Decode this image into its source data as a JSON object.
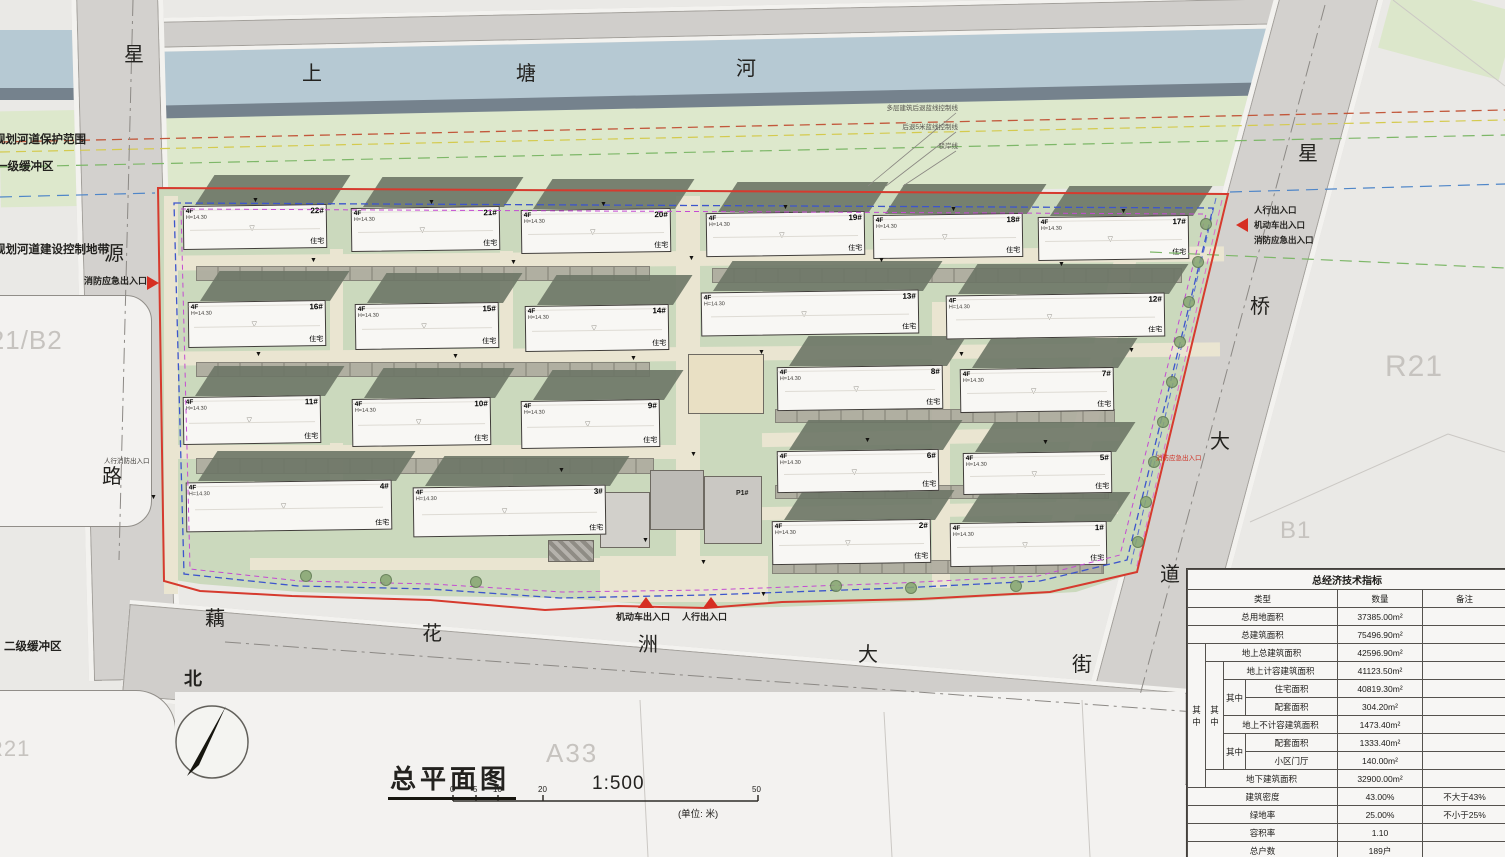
{
  "map": {
    "roads": {
      "north_river_name": [
        "上",
        "塘",
        "河"
      ],
      "west_road_name": [
        "星",
        "源",
        "路"
      ],
      "east_road_name": [
        "星",
        "桥",
        "大",
        "道"
      ],
      "south_road_name": [
        "藕",
        "花",
        "洲",
        "大",
        "街"
      ]
    },
    "zone_labels": {
      "west": "R21/B2",
      "northeast": "R21",
      "east": "B1",
      "south": "A33",
      "southwest": "R21"
    },
    "buffer_labels": {
      "river_protection": "规划河道保护范围",
      "first_buffer": "一级缓冲区",
      "river_control": "规划河道建设控制地带",
      "second_buffer": "二级缓冲区"
    },
    "river_annotations": [
      "多层建筑后退蓝线控制线",
      "后退5米蓝线控制线",
      "驳岸线"
    ],
    "entrances": {
      "west_fire": "消防应急出入口",
      "west_pedestrian_small": "人行消防出入口",
      "south_vehicle": "机动车出入口",
      "south_pedestrian": "人行出入口",
      "east_pedestrian": "人行出入口",
      "east_vehicle": "机动车出入口",
      "east_fire": "消防应急出入口",
      "east_fire_small": "消防应急出入口"
    },
    "gatehouse_label": "P1#",
    "north_label": "北",
    "marker_glyph": "▼",
    "unit_mark": "▽"
  },
  "title_block": {
    "title": "总平面图",
    "scale": "1:500",
    "unit_note": "(单位: 米)",
    "scale_ticks": [
      "0",
      "5",
      "10",
      "20",
      "50"
    ]
  },
  "buildings": [
    {
      "num": "22#",
      "floors": "4F",
      "height": "H=14.30",
      "use": "住宅",
      "x": 183,
      "y": 205,
      "w": 142,
      "h": 42
    },
    {
      "num": "21#",
      "floors": "4F",
      "height": "H=14.30",
      "use": "住宅",
      "x": 351,
      "y": 207,
      "w": 147,
      "h": 42
    },
    {
      "num": "20#",
      "floors": "4F",
      "height": "H=14.30",
      "use": "住宅",
      "x": 521,
      "y": 209,
      "w": 148,
      "h": 42
    },
    {
      "num": "19#",
      "floors": "4F",
      "height": "H=14.30",
      "use": "住宅",
      "x": 706,
      "y": 212,
      "w": 157,
      "h": 42
    },
    {
      "num": "18#",
      "floors": "4F",
      "height": "H=14.30",
      "use": "住宅",
      "x": 873,
      "y": 214,
      "w": 148,
      "h": 42
    },
    {
      "num": "17#",
      "floors": "4F",
      "height": "H=14.30",
      "use": "住宅",
      "x": 1038,
      "y": 216,
      "w": 149,
      "h": 42
    },
    {
      "num": "16#",
      "floors": "4F",
      "height": "H=14.30",
      "use": "住宅",
      "x": 188,
      "y": 301,
      "w": 136,
      "h": 44
    },
    {
      "num": "15#",
      "floors": "4F",
      "height": "H=14.30",
      "use": "住宅",
      "x": 355,
      "y": 303,
      "w": 142,
      "h": 44
    },
    {
      "num": "14#",
      "floors": "4F",
      "height": "H=14.30",
      "use": "住宅",
      "x": 525,
      "y": 305,
      "w": 142,
      "h": 44
    },
    {
      "num": "13#",
      "floors": "4F",
      "height": "H=14.30",
      "use": "住宅",
      "x": 701,
      "y": 291,
      "w": 216,
      "h": 42
    },
    {
      "num": "12#",
      "floors": "4F",
      "height": "H=14.30",
      "use": "住宅",
      "x": 946,
      "y": 294,
      "w": 217,
      "h": 42
    },
    {
      "num": "11#",
      "floors": "4F",
      "height": "H=14.30",
      "use": "住宅",
      "x": 183,
      "y": 396,
      "w": 136,
      "h": 46
    },
    {
      "num": "10#",
      "floors": "4F",
      "height": "H=14.30",
      "use": "住宅",
      "x": 352,
      "y": 398,
      "w": 137,
      "h": 46
    },
    {
      "num": "9#",
      "floors": "4F",
      "height": "H=14.30",
      "use": "住宅",
      "x": 521,
      "y": 400,
      "w": 137,
      "h": 46
    },
    {
      "num": "8#",
      "floors": "4F",
      "height": "H=14.30",
      "use": "住宅",
      "x": 777,
      "y": 366,
      "w": 164,
      "h": 42
    },
    {
      "num": "7#",
      "floors": "4F",
      "height": "H=14.30",
      "use": "住宅",
      "x": 960,
      "y": 368,
      "w": 152,
      "h": 42
    },
    {
      "num": "6#",
      "floors": "4F",
      "height": "H=14.30",
      "use": "住宅",
      "x": 777,
      "y": 450,
      "w": 160,
      "h": 40
    },
    {
      "num": "5#",
      "floors": "4F",
      "height": "H=14.30",
      "use": "住宅",
      "x": 963,
      "y": 452,
      "w": 147,
      "h": 40
    },
    {
      "num": "4#",
      "floors": "4F",
      "height": "H=14.30",
      "use": "住宅",
      "x": 186,
      "y": 481,
      "w": 204,
      "h": 48
    },
    {
      "num": "3#",
      "floors": "4F",
      "height": "H=14.30",
      "use": "住宅",
      "x": 413,
      "y": 486,
      "w": 191,
      "h": 48
    },
    {
      "num": "2#",
      "floors": "4F",
      "height": "H=14.30",
      "use": "住宅",
      "x": 772,
      "y": 520,
      "w": 157,
      "h": 42
    },
    {
      "num": "1#",
      "floors": "4F",
      "height": "H=14.30",
      "use": "住宅",
      "x": 950,
      "y": 522,
      "w": 155,
      "h": 42
    }
  ],
  "markers": [
    [
      252,
      197
    ],
    [
      428,
      199
    ],
    [
      600,
      201
    ],
    [
      782,
      204
    ],
    [
      950,
      206
    ],
    [
      1120,
      208
    ],
    [
      310,
      257
    ],
    [
      510,
      259
    ],
    [
      688,
      255
    ],
    [
      878,
      257
    ],
    [
      1058,
      261
    ],
    [
      255,
      351
    ],
    [
      452,
      353
    ],
    [
      630,
      355
    ],
    [
      758,
      349
    ],
    [
      958,
      351
    ],
    [
      864,
      437
    ],
    [
      1042,
      439
    ],
    [
      690,
      451
    ],
    [
      558,
      467
    ],
    [
      642,
      537
    ],
    [
      760,
      591
    ],
    [
      700,
      559
    ],
    [
      1128,
      347
    ],
    [
      150,
      494
    ]
  ],
  "trees": [
    [
      1200,
      218
    ],
    [
      1192,
      256
    ],
    [
      1183,
      296
    ],
    [
      1174,
      336
    ],
    [
      1166,
      376
    ],
    [
      1157,
      416
    ],
    [
      1148,
      456
    ],
    [
      1140,
      496
    ],
    [
      1132,
      536
    ],
    [
      300,
      570
    ],
    [
      380,
      574
    ],
    [
      470,
      576
    ],
    [
      830,
      580
    ],
    [
      905,
      582
    ],
    [
      1010,
      580
    ]
  ],
  "table": {
    "title": "总经济技术指标",
    "headers": {
      "type": "类型",
      "qty": "数量",
      "note": "备注"
    },
    "qizhong": "其中",
    "rows": {
      "land": {
        "label": "总用地面积",
        "value": "37385.00m²",
        "note": ""
      },
      "total": {
        "label": "总建筑面积",
        "value": "75496.90m²",
        "note": ""
      },
      "above": {
        "label": "地上总建筑面积",
        "value": "42596.90m²",
        "note": ""
      },
      "counted": {
        "label": "地上计容建筑面积",
        "value": "41123.50m²",
        "note": ""
      },
      "resi": {
        "label": "住宅面积",
        "value": "40819.30m²",
        "note": ""
      },
      "support1": {
        "label": "配套面积",
        "value": "304.20m²",
        "note": ""
      },
      "uncounted": {
        "label": "地上不计容建筑面积",
        "value": "1473.40m²",
        "note": ""
      },
      "support2": {
        "label": "配套面积",
        "value": "1333.40m²",
        "note": ""
      },
      "lobby": {
        "label": "小区门厅",
        "value": "140.00m²",
        "note": ""
      },
      "below": {
        "label": "地下建筑面积",
        "value": "32900.00m²",
        "note": ""
      },
      "density": {
        "label": "建筑密度",
        "value": "43.00%",
        "note": "不大于43%"
      },
      "green": {
        "label": "绿地率",
        "value": "25.00%",
        "note": "不小于25%"
      },
      "far": {
        "label": "容积率",
        "value": "1.10",
        "note": ""
      },
      "households": {
        "label": "总户数",
        "value": "189户",
        "note": ""
      }
    }
  }
}
